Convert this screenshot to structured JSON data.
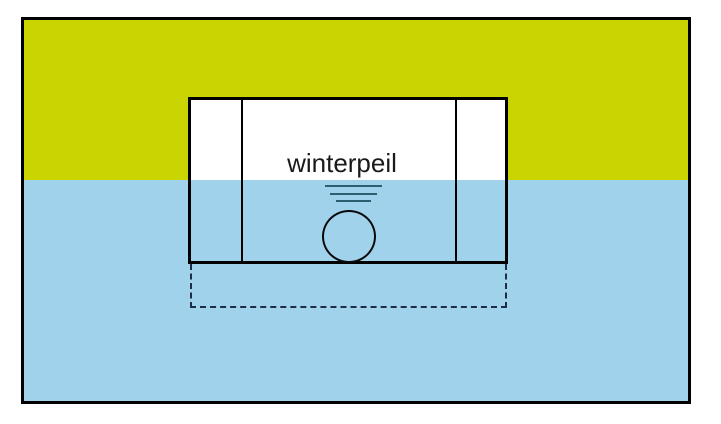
{
  "diagram": {
    "label": "winterpeil",
    "colors": {
      "ground": "#c9d400",
      "water": "#a0d2eb",
      "caisson_fill": "#ffffff",
      "outline": "#000000",
      "water_symbol": "#2e5f6e",
      "dashed_outline": "#1e2c45",
      "page_background": "#ffffff"
    },
    "icons": {
      "water_level_symbol": "water-level-icon"
    }
  }
}
